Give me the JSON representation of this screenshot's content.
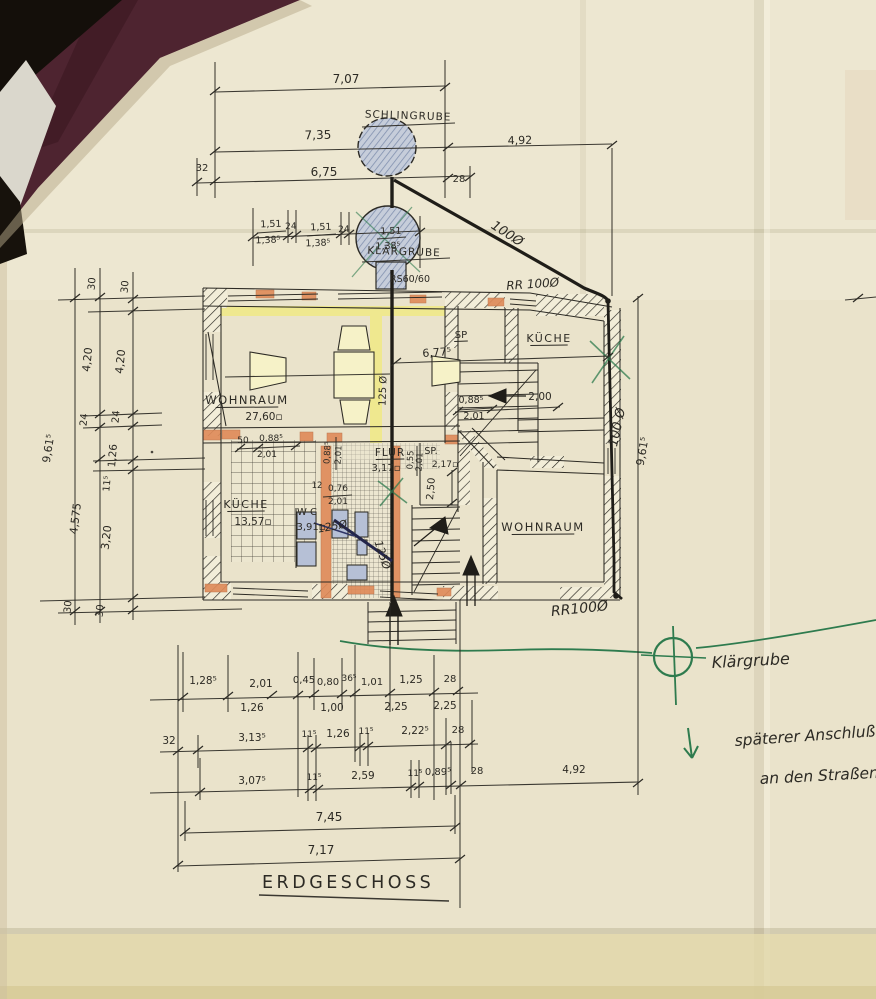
{
  "palette": {
    "paper": "#eae3cb",
    "paper_light": "#efe9d6",
    "paper_bottom": "#e0d5a6",
    "ink": "#2c2a24",
    "blueink": "#2f3566",
    "pencil": "#6c7890",
    "pencil_fill": "#c6cdda",
    "green": "#2e7b4e",
    "orange": "#df8a58",
    "yellow": "#efe88f",
    "maroon": "#4e2430",
    "corner_black": "#140f0a",
    "fixture_blue": "#b6c0d6"
  },
  "drawing_type": "floor-plan",
  "floor_title": "ERDGESCHOSS",
  "labels": [
    {
      "id": "dim-top-7-07",
      "text": "7,07",
      "x": 346,
      "y": 83,
      "size": 12
    },
    {
      "id": "schlingrube-label",
      "text": "SCHLINGRUBE",
      "x": 408,
      "y": 119,
      "size": 10.5,
      "ls": 1,
      "rot": 2
    },
    {
      "id": "dim-top-7-35",
      "text": "7,35",
      "x": 318,
      "y": 139,
      "size": 12,
      "rot": -1
    },
    {
      "id": "dim-top-4-92",
      "text": "4,92",
      "x": 520,
      "y": 144,
      "size": 11,
      "rot": -1
    },
    {
      "id": "dim-top-32",
      "text": "32",
      "x": 202,
      "y": 171,
      "size": 10
    },
    {
      "id": "dim-top-6-75",
      "text": "6,75",
      "x": 324,
      "y": 176,
      "size": 12
    },
    {
      "id": "dim-top-28",
      "text": "28",
      "x": 459,
      "y": 182,
      "size": 10
    },
    {
      "id": "dim-chain-1-51-a",
      "text": "1,51",
      "x": 271,
      "y": 227,
      "size": 9.5,
      "rot": -2
    },
    {
      "id": "dim-chain-1-38-a",
      "text": "1,38⁵",
      "x": 268,
      "y": 243,
      "size": 9.5,
      "rot": -2
    },
    {
      "id": "dim-chain-24-a",
      "text": "24",
      "x": 291,
      "y": 229,
      "size": 9,
      "rot": -2
    },
    {
      "id": "dim-chain-1-51-b",
      "text": "1,51",
      "x": 321,
      "y": 230,
      "size": 9.5,
      "rot": -2
    },
    {
      "id": "dim-chain-1-38-b",
      "text": "1,38⁵",
      "x": 318,
      "y": 246,
      "size": 9.5,
      "rot": -2
    },
    {
      "id": "dim-chain-24-b",
      "text": "24",
      "x": 344,
      "y": 232,
      "size": 9,
      "rot": -2
    },
    {
      "id": "dim-chain-1-51-c",
      "text": "1,51",
      "x": 391,
      "y": 234,
      "size": 9.5,
      "rot": -2
    },
    {
      "id": "dim-chain-1-38-c",
      "text": "1,38⁵",
      "x": 388,
      "y": 249,
      "size": 9.5,
      "rot": -2
    },
    {
      "id": "klaergrube-label",
      "text": "KLÄRGRUBE",
      "x": 404,
      "y": 255,
      "size": 10.5,
      "ls": 1,
      "rot": 2
    },
    {
      "id": "rs60-label",
      "text": "RS60/60",
      "x": 410,
      "y": 282,
      "size": 9.5
    },
    {
      "id": "pipe-100-diagonal",
      "text": "100Ø",
      "x": 505,
      "y": 237,
      "size": 13,
      "rot": 33,
      "hand": true
    },
    {
      "id": "rr100-top",
      "text": "RR 100Ø",
      "x": 533,
      "y": 288,
      "size": 12,
      "rot": -4,
      "hand": true,
      "color": "blueink"
    },
    {
      "id": "pipe-100-right",
      "text": "100 Ø",
      "x": 621,
      "y": 428,
      "size": 13,
      "rot": -78,
      "hand": true
    },
    {
      "id": "dim-right-9-61",
      "text": "9,61⁵",
      "x": 646,
      "y": 452,
      "size": 11,
      "rot": -80
    },
    {
      "id": "rr100-bottom",
      "text": "RR100Ø",
      "x": 580,
      "y": 613,
      "size": 14,
      "rot": -6,
      "hand": true
    },
    {
      "id": "dim-left-30-a",
      "text": "30",
      "x": 95,
      "y": 284,
      "size": 10,
      "rot": -85
    },
    {
      "id": "dim-left-30-b",
      "text": "30",
      "x": 128,
      "y": 287,
      "size": 10,
      "rot": -85
    },
    {
      "id": "dim-left-4-20-a",
      "text": "4,20",
      "x": 91,
      "y": 360,
      "size": 11,
      "rot": -84
    },
    {
      "id": "dim-left-4-20-b",
      "text": "4,20",
      "x": 124,
      "y": 362,
      "size": 11,
      "rot": -84
    },
    {
      "id": "dim-left-24-a",
      "text": "24",
      "x": 87,
      "y": 420,
      "size": 10,
      "rot": -85
    },
    {
      "id": "dim-left-24-b",
      "text": "24",
      "x": 119,
      "y": 417,
      "size": 10,
      "rot": -85
    },
    {
      "id": "dim-left-1-26",
      "text": "1,26",
      "x": 116,
      "y": 456,
      "size": 10.5,
      "rot": -85
    },
    {
      "id": "dim-left-11-5",
      "text": "11⁵",
      "x": 110,
      "y": 484,
      "size": 9.5,
      "rot": -85
    },
    {
      "id": "dim-left-9-61",
      "text": "9,61⁵",
      "x": 52,
      "y": 449,
      "size": 11,
      "rot": -81
    },
    {
      "id": "dim-left-4-575",
      "text": "4,575",
      "x": 79,
      "y": 519,
      "size": 11,
      "rot": -83
    },
    {
      "id": "dim-left-3-20",
      "text": "3,20",
      "x": 110,
      "y": 538,
      "size": 11,
      "rot": -83
    },
    {
      "id": "dim-left-30-c",
      "text": "30",
      "x": 71,
      "y": 607,
      "size": 10,
      "rot": -85
    },
    {
      "id": "dim-left-30-d",
      "text": "30",
      "x": 103,
      "y": 611,
      "size": 10,
      "rot": -85
    },
    {
      "id": "room-wohnraum-left-name",
      "text": "WOHNRAUM",
      "x": 247,
      "y": 404,
      "size": 11.5,
      "ls": 1.5,
      "underline": true
    },
    {
      "id": "room-wohnraum-left-area",
      "text": "27,60▫",
      "x": 264,
      "y": 420,
      "size": 10.5
    },
    {
      "id": "dim-plan-6-77",
      "text": "6,77⁵",
      "x": 437,
      "y": 356,
      "size": 11,
      "rot": -4
    },
    {
      "id": "dim-plan-0-88-a",
      "text": "0,88⁵",
      "x": 471,
      "y": 403,
      "size": 9.5
    },
    {
      "id": "dim-plan-2-01-a",
      "text": "2,01",
      "x": 474,
      "y": 419,
      "size": 9.5
    },
    {
      "id": "dim-plan-2-00",
      "text": "2,00",
      "x": 540,
      "y": 400,
      "size": 10.5
    },
    {
      "id": "room-sp-top-name",
      "text": "SP",
      "x": 461,
      "y": 338,
      "size": 10,
      "underline": true
    },
    {
      "id": "room-kueche-right-name",
      "text": "KÜCHE",
      "x": 549,
      "y": 342,
      "size": 11,
      "ls": 1.5,
      "underline": true
    },
    {
      "id": "dim-plan-50",
      "text": "50",
      "x": 243,
      "y": 443,
      "size": 9
    },
    {
      "id": "dim-plan-0-88-b",
      "text": "0,88⁵",
      "x": 271,
      "y": 441,
      "size": 9
    },
    {
      "id": "dim-plan-2-01-b",
      "text": "2,01",
      "x": 267,
      "y": 457,
      "size": 9
    },
    {
      "id": "dim-plan-0-88-c",
      "text": "0,88⁵",
      "x": 330,
      "y": 453,
      "size": 8.5,
      "rot": -87
    },
    {
      "id": "dim-plan-2-01-c",
      "text": "2,01",
      "x": 341,
      "y": 455,
      "size": 8.5,
      "rot": -87
    },
    {
      "id": "room-flur-name",
      "text": "FLUR",
      "x": 390,
      "y": 456,
      "size": 10.5,
      "ls": 1,
      "underline": true
    },
    {
      "id": "room-flur-area",
      "text": "3,17▫",
      "x": 386,
      "y": 471,
      "size": 10
    },
    {
      "id": "dim-plan-0-55",
      "text": "0,55",
      "x": 413,
      "y": 460,
      "size": 8.5,
      "rot": -87
    },
    {
      "id": "dim-plan-2-01-d",
      "text": "2,01",
      "x": 422,
      "y": 462,
      "size": 8.5,
      "rot": -87
    },
    {
      "id": "room-sp-mid-name",
      "text": "SP.",
      "x": 431,
      "y": 454,
      "size": 9.5
    },
    {
      "id": "room-sp-mid-area",
      "text": "2,17▫",
      "x": 445,
      "y": 467,
      "size": 9
    },
    {
      "id": "dim-plan-2-50",
      "text": "2,50",
      "x": 434,
      "y": 489,
      "size": 10,
      "rot": -85
    },
    {
      "id": "dim-plan-12",
      "text": "12",
      "x": 317,
      "y": 488,
      "size": 8.5
    },
    {
      "id": "dim-plan-0-76",
      "text": "0,76",
      "x": 338,
      "y": 491,
      "size": 9
    },
    {
      "id": "dim-plan-2-01-e",
      "text": "2,01",
      "x": 338,
      "y": 504,
      "size": 9
    },
    {
      "id": "room-wc-name",
      "text": "W C",
      "x": 307,
      "y": 515,
      "size": 10
    },
    {
      "id": "room-wc-area",
      "text": "3,91▫",
      "x": 311,
      "y": 530,
      "size": 10
    },
    {
      "id": "room-kueche-left-name",
      "text": "KÜCHE",
      "x": 246,
      "y": 508,
      "size": 11,
      "ls": 1.5,
      "underline": true
    },
    {
      "id": "room-kueche-left-area",
      "text": "13,57▫",
      "x": 253,
      "y": 525,
      "size": 10.5
    },
    {
      "id": "room-wohnraum-right-name",
      "text": "WOHNRAUM",
      "x": 543,
      "y": 531,
      "size": 11.5,
      "ls": 1.5,
      "underline": true
    },
    {
      "id": "pipe-125-pencil",
      "text": "125 Ø",
      "x": 386,
      "y": 391,
      "size": 10,
      "rot": -88,
      "color": "pencil"
    },
    {
      "id": "pipe-125-blue-a",
      "text": "125Ø",
      "x": 333,
      "y": 530,
      "size": 11,
      "rot": -10,
      "hand": true,
      "color": "blueink"
    },
    {
      "id": "pipe-125-blue-b",
      "text": "125Ø",
      "x": 379,
      "y": 556,
      "size": 11,
      "rot": 72,
      "hand": true,
      "color": "blueink"
    },
    {
      "id": "dim-row1-1-28",
      "text": "1,28⁵",
      "x": 203,
      "y": 684,
      "size": 10.5
    },
    {
      "id": "dim-row1-2-01",
      "text": "2,01",
      "x": 261,
      "y": 687,
      "size": 10.5
    },
    {
      "id": "dim-row1-0-45",
      "text": "0,45",
      "x": 304,
      "y": 683,
      "size": 10
    },
    {
      "id": "dim-row1-0-80",
      "text": "0,80",
      "x": 328,
      "y": 685,
      "size": 10
    },
    {
      "id": "dim-row1-36",
      "text": "36⁵",
      "x": 349,
      "y": 681,
      "size": 9
    },
    {
      "id": "dim-row1-1-01",
      "text": "1,01",
      "x": 372,
      "y": 685,
      "size": 10
    },
    {
      "id": "dim-row1-1-25",
      "text": "1,25",
      "x": 411,
      "y": 683,
      "size": 10.5
    },
    {
      "id": "dim-row1-28",
      "text": "28",
      "x": 450,
      "y": 682,
      "size": 10
    },
    {
      "id": "dim-row1b-1-26",
      "text": "1,26",
      "x": 252,
      "y": 711,
      "size": 10.5
    },
    {
      "id": "dim-row1b-1-00",
      "text": "1,00",
      "x": 332,
      "y": 711,
      "size": 10.5
    },
    {
      "id": "dim-row1b-2-25-a",
      "text": "2,25",
      "x": 396,
      "y": 710,
      "size": 10.5
    },
    {
      "id": "dim-row1b-2-25-b",
      "text": "2,25",
      "x": 445,
      "y": 709,
      "size": 10.5
    },
    {
      "id": "dim-row2-32",
      "text": "32",
      "x": 169,
      "y": 744,
      "size": 10.5
    },
    {
      "id": "dim-row2-3-13",
      "text": "3,13⁵",
      "x": 252,
      "y": 741,
      "size": 10.5
    },
    {
      "id": "dim-row2-11-a",
      "text": "11⁵",
      "x": 309,
      "y": 737,
      "size": 9
    },
    {
      "id": "dim-row2-1-26",
      "text": "1,26",
      "x": 338,
      "y": 737,
      "size": 10.5
    },
    {
      "id": "dim-row2-11-b",
      "text": "11⁵",
      "x": 366,
      "y": 734,
      "size": 9
    },
    {
      "id": "dim-row2-2-22",
      "text": "2,22⁵",
      "x": 415,
      "y": 734,
      "size": 10.5
    },
    {
      "id": "dim-row2-28",
      "text": "28",
      "x": 458,
      "y": 733,
      "size": 10
    },
    {
      "id": "dim-row3-3-07",
      "text": "3,07⁵",
      "x": 252,
      "y": 784,
      "size": 10.5
    },
    {
      "id": "dim-row3-11-a",
      "text": "11⁵",
      "x": 314,
      "y": 780,
      "size": 9
    },
    {
      "id": "dim-row3-2-59",
      "text": "2,59",
      "x": 363,
      "y": 779,
      "size": 10.5
    },
    {
      "id": "dim-row3-11-b",
      "text": "11⁵",
      "x": 415,
      "y": 776,
      "size": 9
    },
    {
      "id": "dim-row3-0-89",
      "text": "0,89⁵",
      "x": 438,
      "y": 775,
      "size": 10
    },
    {
      "id": "dim-row3-28",
      "text": "28",
      "x": 477,
      "y": 774,
      "size": 10
    },
    {
      "id": "dim-row3-4-92",
      "text": "4,92",
      "x": 574,
      "y": 773,
      "size": 10.5
    },
    {
      "id": "dim-row4-7-45",
      "text": "7,45",
      "x": 329,
      "y": 821,
      "size": 12
    },
    {
      "id": "dim-row5-7-17",
      "text": "7,17",
      "x": 321,
      "y": 854,
      "size": 12
    },
    {
      "id": "floor-title",
      "text": "ERDGESCHOSS",
      "x": 262,
      "y": 888,
      "size": 17.5,
      "ls": 3.5,
      "anchor": "start"
    },
    {
      "id": "green-klaergrube-note",
      "text": "Klärgrube",
      "x": 712,
      "y": 668,
      "size": 16,
      "rot": -3,
      "hand": true,
      "color": "green",
      "anchor": "start"
    },
    {
      "id": "green-note-line1",
      "text": "späterer Anschluß",
      "x": 735,
      "y": 746,
      "size": 15.5,
      "rot": -4,
      "hand": true,
      "color": "green",
      "anchor": "start"
    },
    {
      "id": "green-note-line2",
      "text": "an den Straßenka",
      "x": 760,
      "y": 784,
      "size": 15.5,
      "rot": -3,
      "hand": true,
      "color": "green",
      "anchor": "start"
    }
  ]
}
